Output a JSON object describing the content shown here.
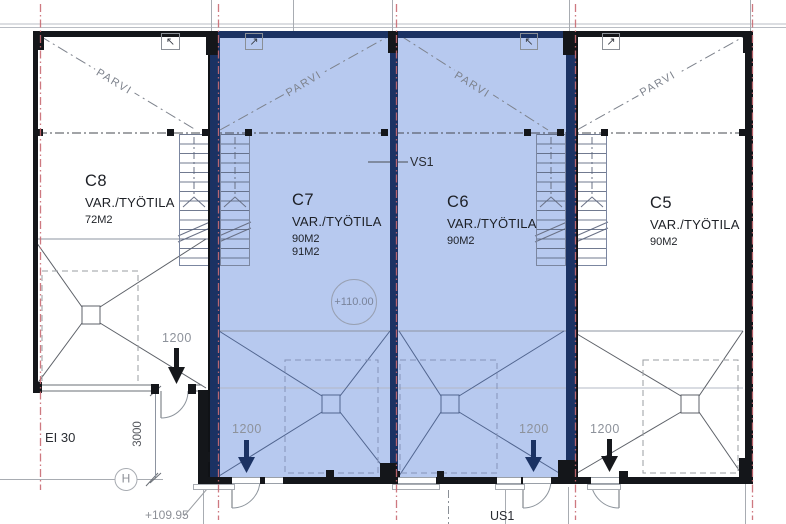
{
  "units": [
    {
      "name": "C8",
      "use": "VAR./TYÖTILA",
      "areas": [
        "72M2"
      ]
    },
    {
      "name": "C7",
      "use": "VAR./TYÖTILA",
      "areas": [
        "90M2",
        "91M2"
      ]
    },
    {
      "name": "C6",
      "use": "VAR./TYÖTILA",
      "areas": [
        "90M2"
      ]
    },
    {
      "name": "C5",
      "use": "VAR./TYÖTILA",
      "areas": [
        "90M2"
      ]
    }
  ],
  "labels": {
    "mezzanine": "PARVI",
    "partition_wall": "VS1",
    "exterior_wall": "US1",
    "fire_rating": "EI 30",
    "grid_row": "H"
  },
  "levels": {
    "floor": "+110.00",
    "ground": "+109.95"
  },
  "dimensions": {
    "slope": "1200",
    "depth": "3000"
  },
  "icons": {
    "slope_nw": "↖",
    "slope_ne": "↗"
  },
  "colors": {
    "highlight_fill": "#b7c9ef",
    "wall_dark": "#1b3263",
    "wall_black": "#14161a",
    "grid_red": "#c96a72"
  }
}
